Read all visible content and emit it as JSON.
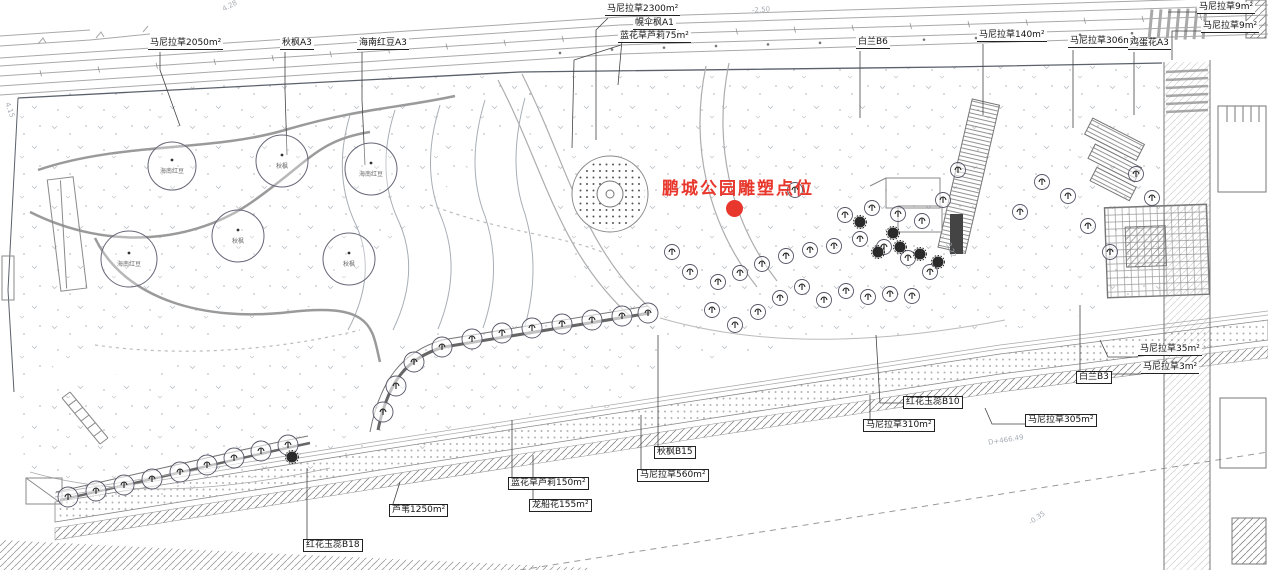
{
  "annotation": {
    "title": "鹏城公园雕塑点位"
  },
  "colors": {
    "highlight": "#e8382d"
  },
  "plant_labels": [
    {
      "text": "马尼拉草2050m²"
    },
    {
      "text": "秋枫A3"
    },
    {
      "text": "海南红豆A3"
    },
    {
      "text": "马尼拉草2300m²"
    },
    {
      "text": "幌伞枫A1"
    },
    {
      "text": "蓝花草芦莉75m²"
    },
    {
      "text": "白兰B6"
    },
    {
      "text": "马尼拉草140m²"
    },
    {
      "text": "马尼拉草306m²"
    },
    {
      "text": "鸡蛋花A3"
    },
    {
      "text": "马尼拉草9m²"
    },
    {
      "text": "马尼拉草9m²"
    },
    {
      "text": "马尼拉草35m²"
    },
    {
      "text": "马尼拉草3m²"
    },
    {
      "text": "白兰B3"
    },
    {
      "text": "红花玉蕊B10"
    },
    {
      "text": "马尼拉草310m²"
    },
    {
      "text": "马尼拉草305m²"
    },
    {
      "text": "秋枫B15"
    },
    {
      "text": "马尼拉草560m²"
    },
    {
      "text": "蓝花草芦莉150m²"
    },
    {
      "text": "龙船花155m²"
    },
    {
      "text": "芦苇1250m²"
    },
    {
      "text": "红花玉蕊B18"
    }
  ],
  "canopy_tree_names": [
    "海南红豆",
    "秋枫",
    "海南红豆",
    "秋枫",
    "海南红豆",
    "秋枫"
  ],
  "elevation_marks": [
    {
      "text": "4.28"
    },
    {
      "text": "-2.50"
    },
    {
      "text": "-1.50"
    },
    {
      "text": "3.22"
    },
    {
      "text": "D+466.49"
    },
    {
      "text": "-0.35"
    },
    {
      "text": "4.15"
    }
  ]
}
